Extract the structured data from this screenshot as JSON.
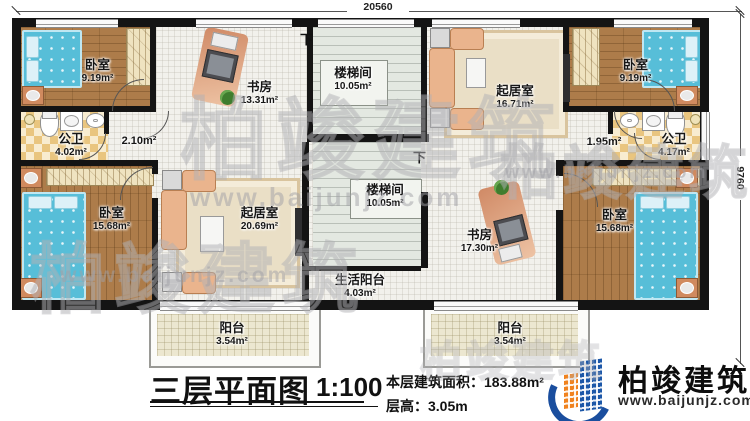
{
  "plan": {
    "dimensions": {
      "top": "20560",
      "right": "9760"
    },
    "stair_down": "下",
    "rooms": [
      {
        "id": "bedroom-top-left",
        "name": "卧室",
        "area": "9.19m²"
      },
      {
        "id": "study-top",
        "name": "书房",
        "area": "13.31m²"
      },
      {
        "id": "stairwell-top",
        "name": "楼梯间",
        "area": "10.05m²"
      },
      {
        "id": "living-top",
        "name": "起居室",
        "area": "16.71m²"
      },
      {
        "id": "bedroom-top-right",
        "name": "卧室",
        "area": "9.19m²"
      },
      {
        "id": "bathroom-left",
        "name": "公卫",
        "area": "4.02m²"
      },
      {
        "id": "hall-left",
        "area": "2.10m²"
      },
      {
        "id": "hall-right",
        "area": "1.95m²"
      },
      {
        "id": "bathroom-right",
        "name": "公卫",
        "area": "4.17m²"
      },
      {
        "id": "bedroom-bottom-left",
        "name": "卧室",
        "area": "15.68m²"
      },
      {
        "id": "living-bottom",
        "name": "起居室",
        "area": "20.69m²"
      },
      {
        "id": "stairwell-bottom",
        "name": "楼梯间",
        "area": "10.05m²"
      },
      {
        "id": "study-bottom",
        "name": "书房",
        "area": "17.30m²"
      },
      {
        "id": "bedroom-bottom-right",
        "name": "卧室",
        "area": "15.68m²"
      },
      {
        "id": "service-balcony",
        "name": "生活阳台",
        "area": "4.03m²"
      },
      {
        "id": "balcony-left",
        "name": "阳台",
        "area": "3.54m²"
      },
      {
        "id": "balcony-right",
        "name": "阳台",
        "area": "3.54m²"
      }
    ]
  },
  "footer": {
    "title": "三层平面图",
    "scale": "1:100",
    "floor_area": "本层建筑面积：183.88m²",
    "floor_height": "层高：3.05m"
  },
  "logo": {
    "company": "柏竣建筑",
    "website": "www.baijunjz.com"
  },
  "watermark": {
    "brand": "柏竣建筑",
    "site": "www.baijunjz.com"
  },
  "colors": {
    "wall": "#141414",
    "wood": "#ad7c4a",
    "bed": "#57bed8",
    "sofa": "#eab48d",
    "logo_blue": "#1c57a8",
    "logo_orange": "#f0821e"
  }
}
